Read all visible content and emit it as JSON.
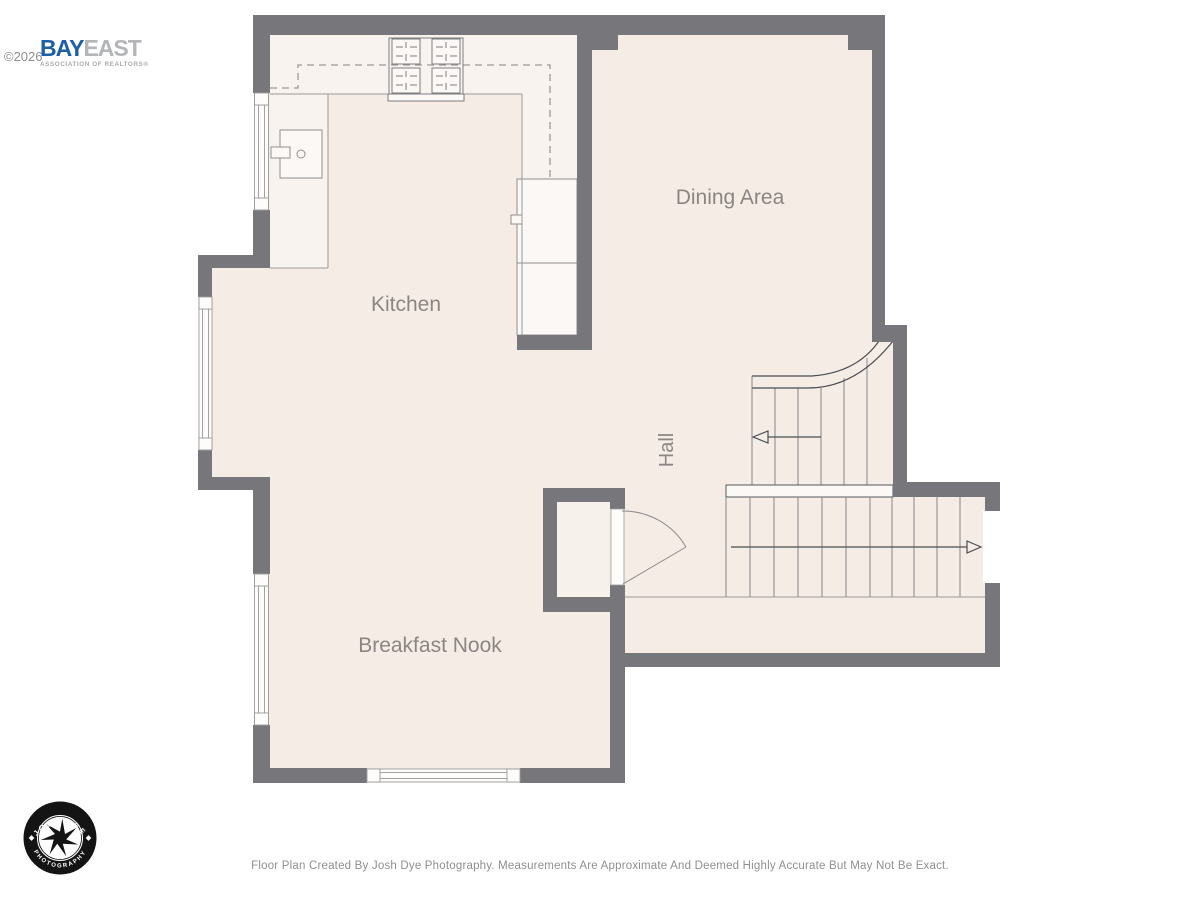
{
  "header": {
    "copyright": "©2026",
    "brand": {
      "primary": "BAY",
      "secondary": "EAST",
      "tagline": "ASSOCIATION OF REALTORS®"
    }
  },
  "floor_plan": {
    "rooms": [
      {
        "name": "Kitchen"
      },
      {
        "name": "Dining Area"
      },
      {
        "name": "Hall"
      },
      {
        "name": "Breakfast Nook"
      }
    ],
    "fixtures": [
      "stove-icon",
      "sink-icon",
      "refrigerator",
      "pantry",
      "upper-cabinets-dashed",
      "stairs-up-arrow",
      "stairs-down-arrow",
      "closet-door-swing",
      "window",
      "sliding-door"
    ]
  },
  "photographer_logo": {
    "top_text": "JOSH DYE",
    "bottom_text": "PHOTOGRAPHY"
  },
  "footer": {
    "disclaimer": "Floor Plan Created By Josh Dye Photography. Measurements Are Approximate And Deemed Highly Accurate But May Not Be Exact."
  },
  "colors": {
    "wall": "#76767b",
    "floor": "#f5ece6",
    "counter": "#f8f3ef",
    "fixture_fill": "#fbf8f6",
    "line": "#9a9a9a",
    "stair_dark_line": "#4c4d51",
    "label_text": "#8b8683",
    "brand_blue": "#1d5fa7",
    "brand_gray": "#b3b5b8",
    "logo_black": "#141414",
    "footer_text": "#8f8f8f"
  }
}
